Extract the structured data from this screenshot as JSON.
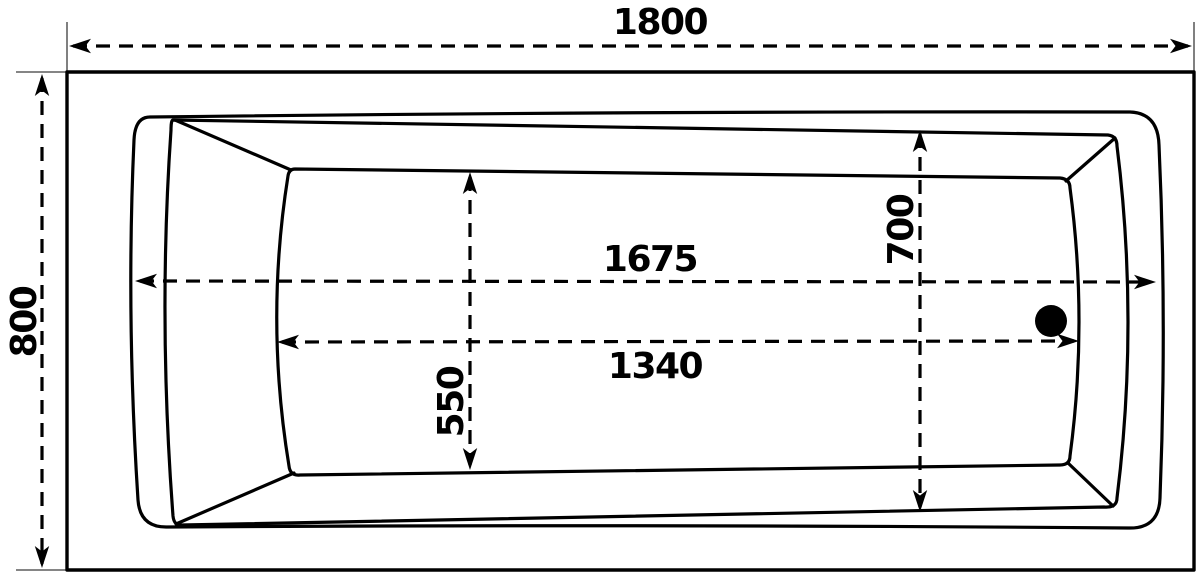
{
  "drawing": {
    "background_color": "#ffffff",
    "line_color": "#000000",
    "extension_line_color": "#3c3c3c",
    "dimensions": [
      {
        "name": "overall-length",
        "value": "1800"
      },
      {
        "name": "overall-width",
        "value": "800"
      },
      {
        "name": "rim-opening-length",
        "value": "1675"
      },
      {
        "name": "basin-floor-length",
        "value": "1340"
      },
      {
        "name": "rim-opening-width",
        "value": "700"
      },
      {
        "name": "basin-floor-width",
        "value": "550"
      }
    ],
    "features": {
      "drain": "drain-hole"
    }
  }
}
